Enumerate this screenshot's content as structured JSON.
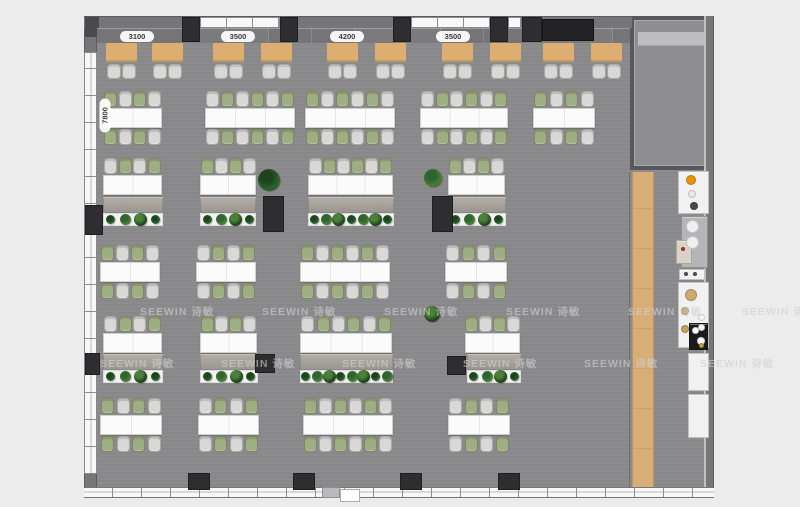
{
  "app": {
    "type": "office-floorplan-top-view",
    "canvas": {
      "w": 800,
      "h": 507
    }
  },
  "watermark": {
    "text": "SEEWIN 诗敏",
    "rows": [
      {
        "y": 304,
        "xs": [
          140,
          262,
          384,
          506,
          628,
          742
        ]
      },
      {
        "y": 356,
        "xs": [
          100,
          221,
          342,
          463,
          584,
          700
        ]
      }
    ]
  },
  "dim_labels": {
    "top": [
      {
        "text": "3100",
        "cx": 137
      },
      {
        "text": "3500",
        "cx": 238
      },
      {
        "text": "4200",
        "cx": 347
      },
      {
        "text": "3500",
        "cx": 453
      }
    ],
    "left": {
      "text": "7800",
      "cx": 105,
      "cy": 116
    }
  },
  "colors": {
    "page_bg": "#ececec",
    "floor": "#8a8a8c",
    "room_floor": "#8e8e90",
    "wall": "#76767a",
    "wall_dark": "#4a4a4c",
    "column": "#2e2e30",
    "window": "#f8f8f8",
    "mullion": "#8e8e90",
    "bench": "#7b7b7e",
    "table_wood": "#dcaf71",
    "table_wood_edge": "#c39a5d",
    "chair_green": "#9fae82",
    "chair_gray": "#d8d8d6",
    "desk": "#fbfbfb",
    "cabinet_hi": "#b2ada6",
    "cabinet_lo": "#9b968f",
    "planter": "#f2f2f2",
    "plant_dark": "#1d441d",
    "plant_mid": "#2f6330",
    "plant_light": "#4a8038",
    "wood_floor": "#d8ae78",
    "fixture_white": "#f1f1f1",
    "accent_orange": "#e8930c",
    "media_black": "#232325",
    "watermark": "#d0d0d0"
  },
  "floorplan": {
    "outer": {
      "x": 84,
      "y": 16,
      "w": 630,
      "h": 482
    },
    "floor": {
      "x": 96,
      "y": 28,
      "w": 609,
      "h": 460
    },
    "left_wall": {
      "x": 84,
      "y": 16,
      "w": 13,
      "h": 482,
      "window_y": 52,
      "window_h": 422
    },
    "right_wall": {
      "x": 704,
      "y": 16,
      "w": 10,
      "h": 482
    },
    "top_wall": {
      "x": 84,
      "y": 16,
      "w": 548,
      "h": 13,
      "windows": [
        {
          "x": 200,
          "w": 80
        },
        {
          "x": 411,
          "w": 79
        },
        {
          "x": 508,
          "w": 13
        }
      ],
      "columns": [
        {
          "x": 182,
          "w": 18
        },
        {
          "x": 280,
          "w": 18
        },
        {
          "x": 393,
          "w": 18
        },
        {
          "x": 490,
          "w": 18
        },
        {
          "x": 522,
          "w": 20
        }
      ],
      "media_box": {
        "x": 542,
        "y": 19,
        "w": 52,
        "h": 22
      }
    },
    "bottom_wall": {
      "x": 84,
      "y": 487,
      "w": 630,
      "h": 11,
      "columns": [
        {
          "x": 188
        },
        {
          "x": 293
        },
        {
          "x": 400
        },
        {
          "x": 498
        }
      ],
      "door": {
        "leaf_x": 322,
        "leaf_w": 18,
        "tab_x": 340,
        "tab_w": 20
      }
    },
    "corner_block": {
      "x": 85,
      "y": 17,
      "w": 14,
      "h": 20
    },
    "meeting_room": {
      "x": 630,
      "y": 16,
      "w": 82,
      "h": 154,
      "board": {
        "x": 638,
        "y": 32,
        "w": 66,
        "h": 14
      }
    },
    "wood_walkway": {
      "x": 632,
      "y": 172,
      "w": 22,
      "h": 316
    },
    "bench": {
      "x": 97,
      "y": 28,
      "w": 533,
      "h": 15
    },
    "booth_tables": {
      "y": 43,
      "h": 19,
      "w": 31,
      "xs": [
        106,
        152,
        213,
        261,
        327,
        375,
        442,
        490,
        543,
        591
      ]
    },
    "booth_chairs": {
      "y": 64,
      "w": 14,
      "h": 15
    },
    "desk_rows": [
      {
        "desk_y": 108,
        "sides": 2,
        "clusters": [
          {
            "x": 103,
            "w": 59,
            "seats": 4
          },
          {
            "x": 205,
            "w": 90,
            "seats": 6
          },
          {
            "x": 305,
            "w": 90,
            "seats": 6
          },
          {
            "x": 420,
            "w": 88,
            "seats": 6
          },
          {
            "x": 533,
            "w": 62,
            "seats": 4
          }
        ]
      },
      {
        "desk_y": 175,
        "sides": 1,
        "clusters": [
          {
            "x": 103,
            "w": 59,
            "seats": 4
          },
          {
            "x": 200,
            "w": 56,
            "seats": 4
          },
          {
            "x": 308,
            "w": 85,
            "seats": 6
          },
          {
            "x": 448,
            "w": 57,
            "seats": 4
          }
        ]
      },
      {
        "desk_y": 262,
        "sides": 2,
        "clusters": [
          {
            "x": 100,
            "w": 60,
            "seats": 4
          },
          {
            "x": 196,
            "w": 60,
            "seats": 4
          },
          {
            "x": 300,
            "w": 90,
            "seats": 6
          },
          {
            "x": 445,
            "w": 62,
            "seats": 4
          }
        ]
      },
      {
        "desk_y": 333,
        "sides": 1,
        "clusters": [
          {
            "x": 103,
            "w": 59,
            "seats": 4
          },
          {
            "x": 200,
            "w": 57,
            "seats": 4
          },
          {
            "x": 300,
            "w": 92,
            "seats": 6
          },
          {
            "x": 465,
            "w": 55,
            "seats": 4
          }
        ]
      },
      {
        "desk_y": 415,
        "sides": 2,
        "clusters": [
          {
            "x": 100,
            "w": 62,
            "seats": 4
          },
          {
            "x": 198,
            "w": 61,
            "seats": 4
          },
          {
            "x": 303,
            "w": 90,
            "seats": 6
          },
          {
            "x": 448,
            "w": 62,
            "seats": 4
          }
        ]
      }
    ],
    "storage_rows": [
      {
        "cab_y": 197,
        "planter_y": 213,
        "groups": [
          {
            "x": 103,
            "w": 60,
            "plants": 4
          },
          {
            "x": 200,
            "w": 56,
            "plants": 4
          },
          {
            "x": 308,
            "w": 86,
            "plants": 7
          },
          {
            "x": 448,
            "w": 58,
            "plants": 4
          }
        ]
      },
      {
        "cab_y": 354,
        "planter_y": 370,
        "groups": [
          {
            "x": 103,
            "w": 60,
            "plants": 4
          },
          {
            "x": 200,
            "w": 58,
            "plants": 4
          },
          {
            "x": 300,
            "w": 93,
            "plants": 8
          },
          {
            "x": 467,
            "w": 54,
            "plants": 4
          }
        ]
      }
    ],
    "interior_columns": [
      {
        "x": 85,
        "y": 205,
        "w": 18,
        "h": 30
      },
      {
        "x": 263,
        "y": 196,
        "w": 21,
        "h": 36
      },
      {
        "x": 432,
        "y": 196,
        "w": 21,
        "h": 36
      },
      {
        "x": 85,
        "y": 353,
        "w": 15,
        "h": 22
      },
      {
        "x": 255,
        "y": 354,
        "w": 20,
        "h": 19
      },
      {
        "x": 447,
        "y": 356,
        "w": 19,
        "h": 19
      }
    ],
    "bottom_columns_y": 473,
    "standalone_plants": [
      {
        "x": 258,
        "y": 169,
        "s": 22
      },
      {
        "x": 424,
        "y": 169,
        "s": 18
      },
      {
        "x": 424,
        "y": 306,
        "s": 16
      }
    ],
    "fixtures": [
      {
        "name": "water-dispenser",
        "x": 678,
        "y": 171,
        "w": 31,
        "h": 43,
        "bg": "#f1f1f1"
      },
      {
        "name": "coffee-station-panel",
        "x": 681,
        "y": 216,
        "w": 27,
        "h": 52,
        "bg": "#b5b5b7"
      },
      {
        "name": "vending-machine",
        "x": 676,
        "y": 240,
        "w": 16,
        "h": 24,
        "bg": "#d8d2c8"
      },
      {
        "name": "appliance-shelf",
        "x": 679,
        "y": 269,
        "w": 26,
        "h": 11,
        "bg": "#f1f1f1"
      },
      {
        "name": "pantry-counter",
        "x": 678,
        "y": 282,
        "w": 31,
        "h": 66,
        "bg": "#f1f1f1"
      },
      {
        "name": "cooktop-unit",
        "x": 689,
        "y": 323,
        "w": 19,
        "h": 27,
        "bg": "#1b1b1d"
      },
      {
        "name": "wall-cabinet",
        "x": 688,
        "y": 353,
        "w": 21,
        "h": 38,
        "bg": "#f1f1f1"
      },
      {
        "name": "wall-cabinet",
        "x": 688,
        "y": 394,
        "w": 21,
        "h": 44,
        "bg": "#f1f1f1"
      }
    ],
    "fixture_dots": [
      {
        "name": "dispenser-burner-orange",
        "x": 686,
        "y": 175,
        "s": 10,
        "c": "#e8930c"
      },
      {
        "name": "dispenser-ring",
        "x": 688,
        "y": 190,
        "s": 8,
        "c": "#e9e9e9"
      },
      {
        "name": "dispenser-tap-dark",
        "x": 690,
        "y": 202,
        "s": 8,
        "c": "#4a4a4c"
      },
      {
        "name": "coffee-cup-white",
        "x": 686,
        "y": 220,
        "s": 13,
        "c": "#efefef"
      },
      {
        "name": "coffee-cup-white",
        "x": 686,
        "y": 236,
        "s": 13,
        "c": "#efefef"
      },
      {
        "name": "machine-red-dot",
        "x": 681,
        "y": 247,
        "s": 4,
        "c": "#c23327"
      },
      {
        "name": "shelf-knob",
        "x": 684,
        "y": 272,
        "s": 4,
        "c": "#555558"
      },
      {
        "name": "shelf-knob",
        "x": 693,
        "y": 272,
        "s": 4,
        "c": "#555558"
      },
      {
        "name": "sink-bowl-tan",
        "x": 685,
        "y": 289,
        "s": 12,
        "c": "#cfa96d"
      },
      {
        "name": "counter-item-tan",
        "x": 681,
        "y": 307,
        "s": 8,
        "c": "#c8a05c"
      },
      {
        "name": "counter-item-tan",
        "x": 681,
        "y": 325,
        "s": 8,
        "c": "#c8a05c"
      },
      {
        "name": "counter-plate",
        "x": 698,
        "y": 314,
        "s": 7,
        "c": "#f6f6f6"
      },
      {
        "name": "counter-plate",
        "x": 698,
        "y": 324,
        "s": 7,
        "c": "#f6f6f6"
      },
      {
        "name": "burner-white",
        "x": 692,
        "y": 327,
        "s": 7,
        "c": "#ffffff"
      },
      {
        "name": "burner-white",
        "x": 697,
        "y": 337,
        "s": 8,
        "c": "#ffffff"
      },
      {
        "name": "counter-item-yellow",
        "x": 699,
        "y": 343,
        "s": 5,
        "c": "#cfa23a"
      }
    ]
  }
}
